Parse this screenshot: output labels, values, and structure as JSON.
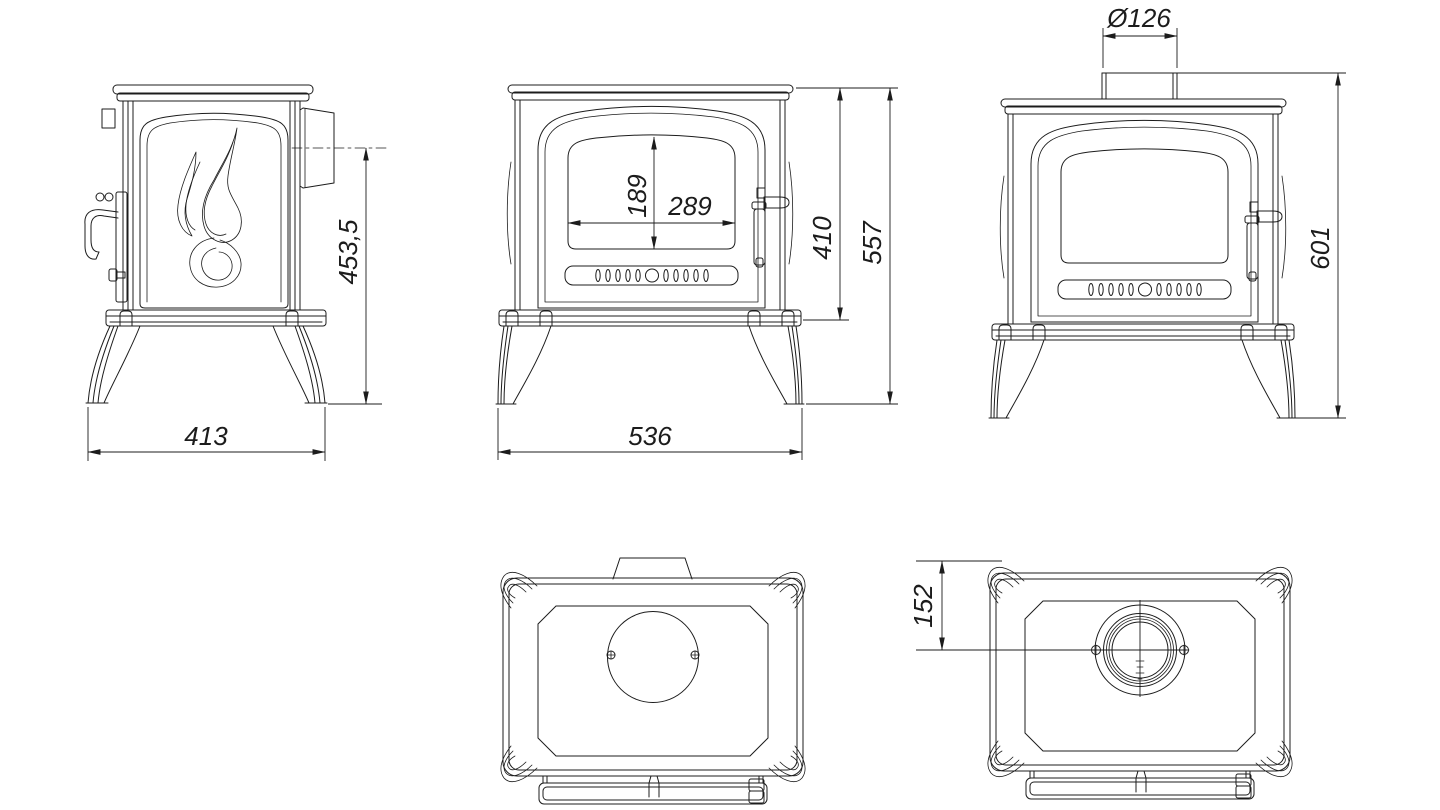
{
  "drawing": {
    "background": "#ffffff",
    "line_color": "#1c1c1c",
    "views": {
      "side_view": {
        "name": "side view",
        "dimensions": {
          "depth": "413",
          "rear_flue_center_height": "453,5"
        }
      },
      "front_view": {
        "name": "front view",
        "dimensions": {
          "glass_height": "189",
          "glass_width": "289",
          "body_height": "410",
          "overall_height": "557",
          "overall_width": "536"
        }
      },
      "rear_flue_view": {
        "name": "front view with flue collar",
        "dimensions": {
          "flue_diameter": "Ø126",
          "height_with_flue_collar": "601"
        }
      },
      "top_view": {
        "name": "top view (flue opening blanked)"
      },
      "top_view_with_collar": {
        "name": "top view with flue collar",
        "dimensions": {
          "flue_center_from_back": "152"
        }
      }
    }
  }
}
